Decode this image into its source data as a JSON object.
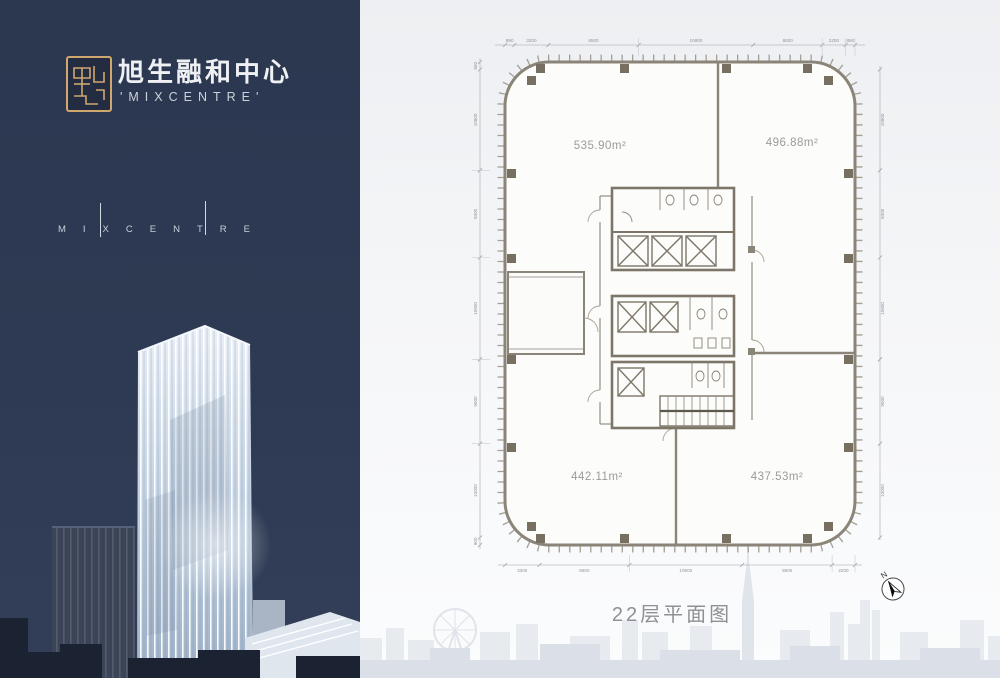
{
  "brand": {
    "title_cn": "旭生融和中心",
    "title_en": "'MIXCENTRE'",
    "wordmark": "MIXCENTRE"
  },
  "plan": {
    "caption": "22层平面图",
    "north_label": "N",
    "areas": {
      "top_left": "535.90m²",
      "top_right": "496.88m²",
      "bottom_left": "442.11m²",
      "bottom_right": "437.53m²"
    },
    "dims": {
      "top": [
        "890",
        "3200",
        "8500",
        "10800",
        "6500",
        "2200",
        "890"
      ],
      "bottom": [
        "3300",
        "8600",
        "10800",
        "8600",
        "2200"
      ],
      "left": [
        "800",
        "10800",
        "9300",
        "10800",
        "9000",
        "10000",
        "800"
      ],
      "right": [
        "10800",
        "9300",
        "10800",
        "9000",
        "10000"
      ]
    }
  },
  "colors": {
    "navy": "#2e3a53",
    "gold": "#cfa76f",
    "wall": "#8b8478",
    "panel_bg": "#eff1f4",
    "silhouette": "#e2e5eb",
    "caption_gray": "#8f9094"
  }
}
